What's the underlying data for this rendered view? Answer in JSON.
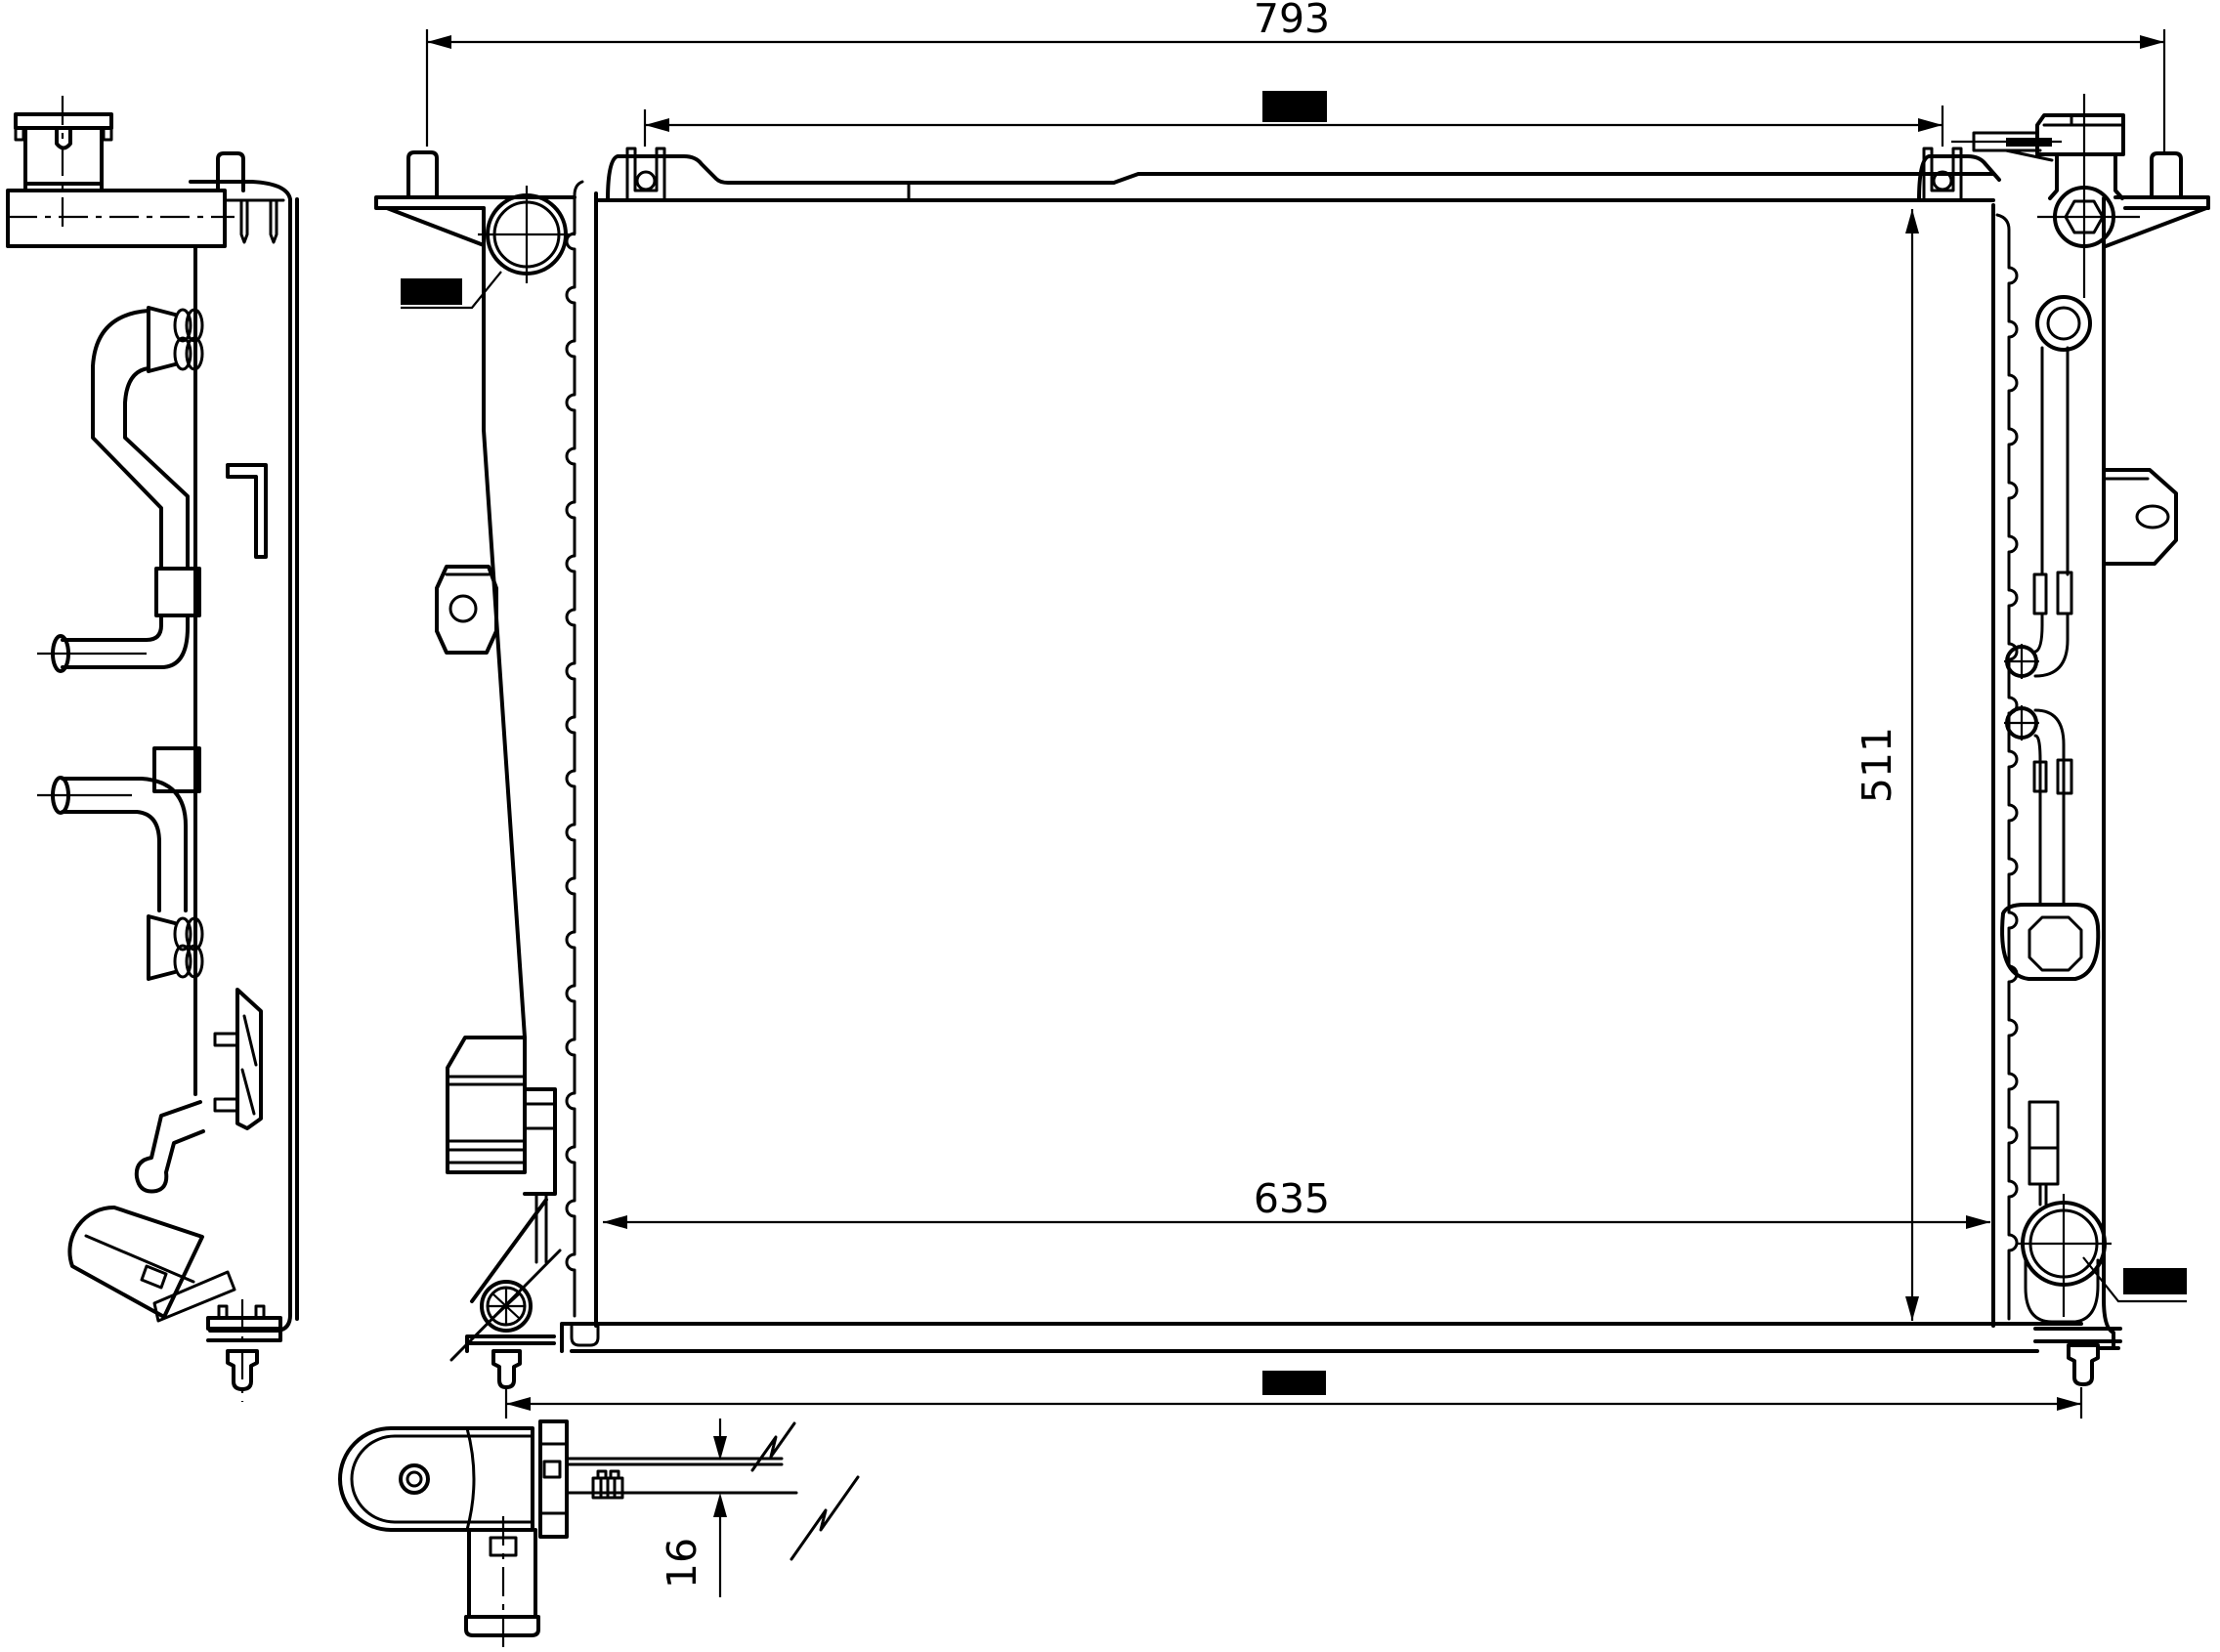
{
  "drawing": {
    "type": "engineering-line-drawing",
    "subject": "radiator-assembly-three-views",
    "colors": {
      "background": "#ffffff",
      "line": "#000000",
      "redaction_box": "#000000"
    },
    "dimensions": {
      "top_width": "793",
      "core_height": "511",
      "core_width": "635",
      "bracket_thickness": "16"
    },
    "redactions": {
      "count": 4
    }
  }
}
